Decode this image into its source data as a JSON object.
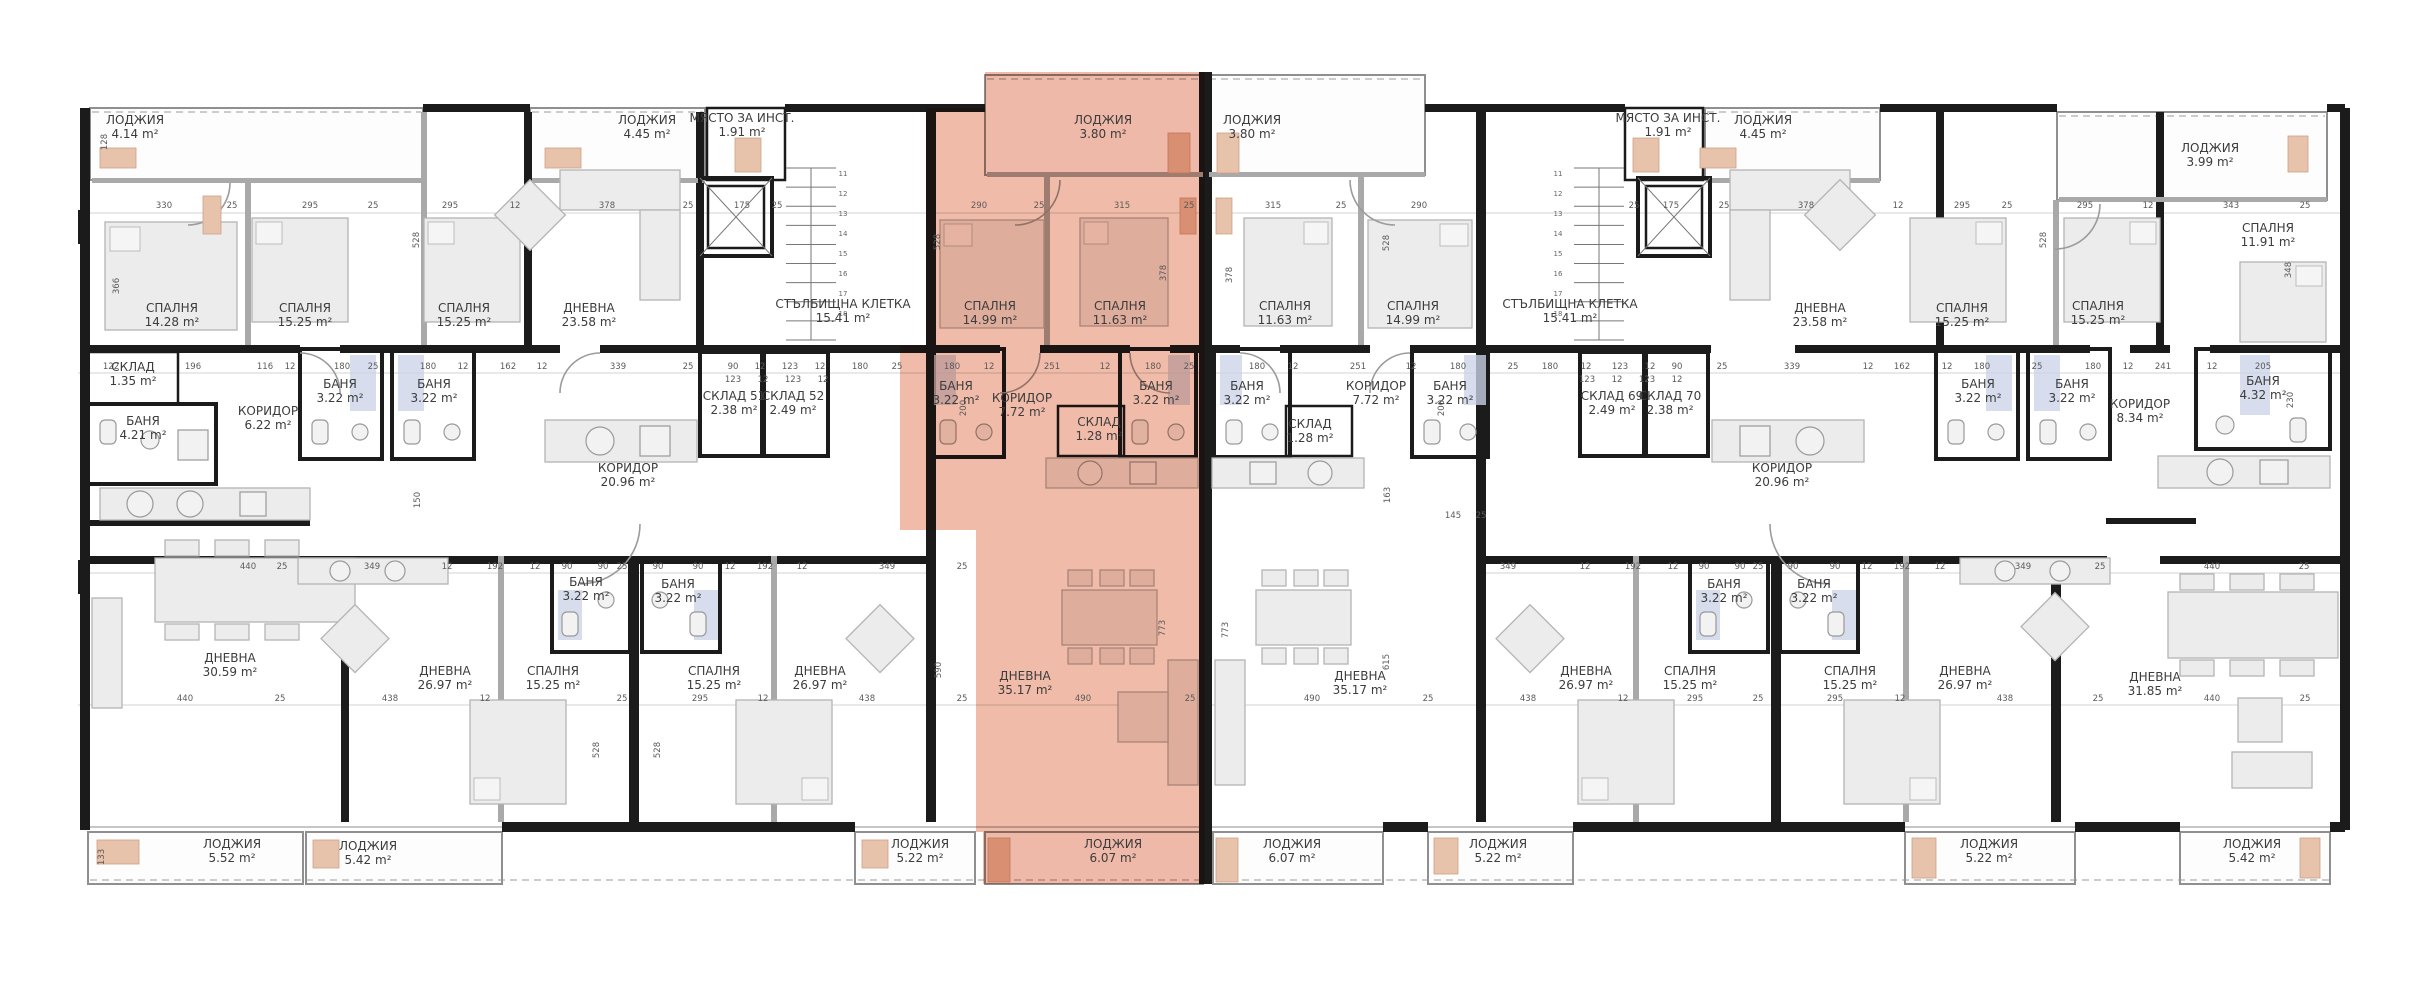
{
  "plan": {
    "type": "apartment-building-floor-plan",
    "language": "bg",
    "unit": "m²",
    "highlight_color": "#e06c4e",
    "wall_color": "#1b1b1b"
  },
  "rooms": [
    {
      "n": "ЛОДЖИЯ",
      "a": "4.14 m²",
      "x": 135,
      "y": 124,
      "hl": false
    },
    {
      "n": "ЛОДЖИЯ",
      "a": "4.45 m²",
      "x": 647,
      "y": 124,
      "hl": false
    },
    {
      "n": "МЯСТО ЗА ИНСТ.",
      "a": "1.91 m²",
      "x": 742,
      "y": 122,
      "hl": false
    },
    {
      "n": "ЛОДЖИЯ",
      "a": "3.80 m²",
      "x": 1103,
      "y": 124,
      "hl": true
    },
    {
      "n": "ЛОДЖИЯ",
      "a": "3.80 m²",
      "x": 1252,
      "y": 124,
      "hl": false
    },
    {
      "n": "МЯСТО ЗА ИНСТ.",
      "a": "1.91 m²",
      "x": 1668,
      "y": 122,
      "hl": false
    },
    {
      "n": "ЛОДЖИЯ",
      "a": "4.45 m²",
      "x": 1763,
      "y": 124,
      "hl": false
    },
    {
      "n": "ЛОДЖИЯ",
      "a": "3.99 m²",
      "x": 2210,
      "y": 152,
      "hl": false
    },
    {
      "n": "СПАЛНЯ",
      "a": "14.28 m²",
      "x": 172,
      "y": 312,
      "hl": false
    },
    {
      "n": "СПАЛНЯ",
      "a": "15.25 m²",
      "x": 305,
      "y": 312,
      "hl": false
    },
    {
      "n": "СПАЛНЯ",
      "a": "15.25 m²",
      "x": 464,
      "y": 312,
      "hl": false
    },
    {
      "n": "ДНЕВНА",
      "a": "23.58 m²",
      "x": 589,
      "y": 312,
      "hl": false
    },
    {
      "n": "СТЪЛБИЩНА КЛЕТКА",
      "a": "15.41 m²",
      "x": 843,
      "y": 308,
      "hl": false
    },
    {
      "n": "СПАЛНЯ",
      "a": "14.99 m²",
      "x": 990,
      "y": 310,
      "hl": true
    },
    {
      "n": "СПАЛНЯ",
      "a": "11.63 m²",
      "x": 1120,
      "y": 310,
      "hl": true
    },
    {
      "n": "СПАЛНЯ",
      "a": "11.63 m²",
      "x": 1285,
      "y": 310,
      "hl": false
    },
    {
      "n": "СПАЛНЯ",
      "a": "14.99 m²",
      "x": 1413,
      "y": 310,
      "hl": false
    },
    {
      "n": "СТЪЛБИЩНА КЛЕТКА",
      "a": "15.41 m²",
      "x": 1570,
      "y": 308,
      "hl": false
    },
    {
      "n": "ДНЕВНА",
      "a": "23.58 m²",
      "x": 1820,
      "y": 312,
      "hl": false
    },
    {
      "n": "СПАЛНЯ",
      "a": "15.25 m²",
      "x": 1962,
      "y": 312,
      "hl": false
    },
    {
      "n": "СПАЛНЯ",
      "a": "15.25 m²",
      "x": 2098,
      "y": 310,
      "hl": false
    },
    {
      "n": "СПАЛНЯ",
      "a": "11.91 m²",
      "x": 2268,
      "y": 232,
      "hl": false
    },
    {
      "n": "СКЛАД",
      "a": "1.35 m²",
      "x": 133,
      "y": 371,
      "hl": false
    },
    {
      "n": "БАНЯ",
      "a": "4.21 m²",
      "x": 143,
      "y": 425,
      "hl": false
    },
    {
      "n": "КОРИДОР",
      "a": "6.22 m²",
      "x": 268,
      "y": 415,
      "hl": false
    },
    {
      "n": "БАНЯ",
      "a": "3.22 m²",
      "x": 340,
      "y": 388,
      "hl": false
    },
    {
      "n": "БАНЯ",
      "a": "3.22 m²",
      "x": 434,
      "y": 388,
      "hl": false
    },
    {
      "n": "КОРИДОР",
      "a": "20.96 m²",
      "x": 628,
      "y": 472,
      "hl": false
    },
    {
      "n": "СКЛАД 51",
      "a": "2.38 m²",
      "x": 734,
      "y": 400,
      "hl": false
    },
    {
      "n": "СКЛАД 52",
      "a": "2.49 m²",
      "x": 793,
      "y": 400,
      "hl": false
    },
    {
      "n": "БАНЯ",
      "a": "3.22 m²",
      "x": 956,
      "y": 390,
      "hl": true
    },
    {
      "n": "КОРИДОР",
      "a": "7.72 m²",
      "x": 1022,
      "y": 402,
      "hl": true
    },
    {
      "n": "СКЛАД",
      "a": "1.28 m²",
      "x": 1099,
      "y": 426,
      "hl": true
    },
    {
      "n": "БАНЯ",
      "a": "3.22 m²",
      "x": 1156,
      "y": 390,
      "hl": true
    },
    {
      "n": "БАНЯ",
      "a": "3.22 m²",
      "x": 1247,
      "y": 390,
      "hl": false
    },
    {
      "n": "СКЛАД",
      "a": "1.28 m²",
      "x": 1310,
      "y": 428,
      "hl": false
    },
    {
      "n": "КОРИДОР",
      "a": "7.72 m²",
      "x": 1376,
      "y": 390,
      "hl": false
    },
    {
      "n": "БАНЯ",
      "a": "3.22 m²",
      "x": 1450,
      "y": 390,
      "hl": false
    },
    {
      "n": "СКЛАД 69",
      "a": "2.49 m²",
      "x": 1612,
      "y": 400,
      "hl": false
    },
    {
      "n": "СКЛАД 70",
      "a": "2.38 m²",
      "x": 1670,
      "y": 400,
      "hl": false
    },
    {
      "n": "КОРИДОР",
      "a": "20.96 m²",
      "x": 1782,
      "y": 472,
      "hl": false
    },
    {
      "n": "БАНЯ",
      "a": "3.22 m²",
      "x": 1978,
      "y": 388,
      "hl": false
    },
    {
      "n": "БАНЯ",
      "a": "3.22 m²",
      "x": 2072,
      "y": 388,
      "hl": false
    },
    {
      "n": "КОРИДОР",
      "a": "8.34 m²",
      "x": 2140,
      "y": 408,
      "hl": false
    },
    {
      "n": "БАНЯ",
      "a": "4.32 m²",
      "x": 2263,
      "y": 385,
      "hl": false
    },
    {
      "n": "БАНЯ",
      "a": "3.22 m²",
      "x": 586,
      "y": 586,
      "hl": false
    },
    {
      "n": "БАНЯ",
      "a": "3.22 m²",
      "x": 678,
      "y": 588,
      "hl": false
    },
    {
      "n": "БАНЯ",
      "a": "3.22 m²",
      "x": 1724,
      "y": 588,
      "hl": false
    },
    {
      "n": "БАНЯ",
      "a": "3.22 m²",
      "x": 1814,
      "y": 588,
      "hl": false
    },
    {
      "n": "ДНЕВНА",
      "a": "30.59 m²",
      "x": 230,
      "y": 662,
      "hl": false
    },
    {
      "n": "ДНЕВНА",
      "a": "26.97 m²",
      "x": 445,
      "y": 675,
      "hl": false
    },
    {
      "n": "СПАЛНЯ",
      "a": "15.25 m²",
      "x": 553,
      "y": 675,
      "hl": false
    },
    {
      "n": "СПАЛНЯ",
      "a": "15.25 m²",
      "x": 714,
      "y": 675,
      "hl": false
    },
    {
      "n": "ДНЕВНА",
      "a": "26.97 m²",
      "x": 820,
      "y": 675,
      "hl": false
    },
    {
      "n": "ДНЕВНА",
      "a": "35.17 m²",
      "x": 1025,
      "y": 680,
      "hl": true
    },
    {
      "n": "ДНЕВНА",
      "a": "35.17 m²",
      "x": 1360,
      "y": 680,
      "hl": false
    },
    {
      "n": "ДНЕВНА",
      "a": "26.97 m²",
      "x": 1586,
      "y": 675,
      "hl": false
    },
    {
      "n": "СПАЛНЯ",
      "a": "15.25 m²",
      "x": 1690,
      "y": 675,
      "hl": false
    },
    {
      "n": "СПАЛНЯ",
      "a": "15.25 m²",
      "x": 1850,
      "y": 675,
      "hl": false
    },
    {
      "n": "ДНЕВНА",
      "a": "26.97 m²",
      "x": 1965,
      "y": 675,
      "hl": false
    },
    {
      "n": "ДНЕВНА",
      "a": "31.85 m²",
      "x": 2155,
      "y": 681,
      "hl": false
    },
    {
      "n": "ЛОДЖИЯ",
      "a": "5.52 m²",
      "x": 232,
      "y": 848,
      "hl": false
    },
    {
      "n": "ЛОДЖИЯ",
      "a": "5.42 m²",
      "x": 368,
      "y": 850,
      "hl": false
    },
    {
      "n": "ЛОДЖИЯ",
      "a": "5.22 m²",
      "x": 920,
      "y": 848,
      "hl": false
    },
    {
      "n": "ЛОДЖИЯ",
      "a": "6.07 m²",
      "x": 1113,
      "y": 848,
      "hl": true
    },
    {
      "n": "ЛОДЖИЯ",
      "a": "6.07 m²",
      "x": 1292,
      "y": 848,
      "hl": false
    },
    {
      "n": "ЛОДЖИЯ",
      "a": "5.22 m²",
      "x": 1498,
      "y": 848,
      "hl": false
    },
    {
      "n": "ЛОДЖИЯ",
      "a": "5.22 m²",
      "x": 1989,
      "y": 848,
      "hl": false
    },
    {
      "n": "ЛОДЖИЯ",
      "a": "5.42 m²",
      "x": 2252,
      "y": 848,
      "hl": false
    }
  ],
  "dimensions": {
    "horizontal": [
      {
        "t": "330",
        "x": 164,
        "y": 208
      },
      {
        "t": "25",
        "x": 232,
        "y": 208
      },
      {
        "t": "295",
        "x": 310,
        "y": 208
      },
      {
        "t": "25",
        "x": 373,
        "y": 208
      },
      {
        "t": "295",
        "x": 450,
        "y": 208
      },
      {
        "t": "12",
        "x": 515,
        "y": 208
      },
      {
        "t": "378",
        "x": 607,
        "y": 208
      },
      {
        "t": "25",
        "x": 688,
        "y": 208
      },
      {
        "t": "175",
        "x": 742,
        "y": 208
      },
      {
        "t": "25",
        "x": 777,
        "y": 208
      },
      {
        "t": "290",
        "x": 979,
        "y": 208
      },
      {
        "t": "25",
        "x": 1039,
        "y": 208
      },
      {
        "t": "315",
        "x": 1122,
        "y": 208
      },
      {
        "t": "25",
        "x": 1189,
        "y": 208
      },
      {
        "t": "315",
        "x": 1273,
        "y": 208
      },
      {
        "t": "25",
        "x": 1341,
        "y": 208
      },
      {
        "t": "290",
        "x": 1419,
        "y": 208
      },
      {
        "t": "25",
        "x": 1634,
        "y": 208
      },
      {
        "t": "175",
        "x": 1671,
        "y": 208
      },
      {
        "t": "25",
        "x": 1724,
        "y": 208
      },
      {
        "t": "378",
        "x": 1806,
        "y": 208
      },
      {
        "t": "12",
        "x": 1898,
        "y": 208
      },
      {
        "t": "295",
        "x": 1962,
        "y": 208
      },
      {
        "t": "25",
        "x": 2007,
        "y": 208
      },
      {
        "t": "295",
        "x": 2085,
        "y": 208
      },
      {
        "t": "12",
        "x": 2148,
        "y": 208
      },
      {
        "t": "343",
        "x": 2231,
        "y": 208
      },
      {
        "t": "25",
        "x": 2305,
        "y": 208
      },
      {
        "t": "122",
        "x": 111,
        "y": 369
      },
      {
        "t": "196",
        "x": 193,
        "y": 369
      },
      {
        "t": "116",
        "x": 265,
        "y": 369
      },
      {
        "t": "12",
        "x": 290,
        "y": 369
      },
      {
        "t": "180",
        "x": 342,
        "y": 369
      },
      {
        "t": "25",
        "x": 373,
        "y": 369
      },
      {
        "t": "180",
        "x": 428,
        "y": 369
      },
      {
        "t": "12",
        "x": 463,
        "y": 369
      },
      {
        "t": "162",
        "x": 508,
        "y": 369
      },
      {
        "t": "12",
        "x": 542,
        "y": 369
      },
      {
        "t": "339",
        "x": 618,
        "y": 369
      },
      {
        "t": "25",
        "x": 688,
        "y": 369
      },
      {
        "t": "90",
        "x": 733,
        "y": 369
      },
      {
        "t": "12",
        "x": 760,
        "y": 369
      },
      {
        "t": "123",
        "x": 790,
        "y": 369
      },
      {
        "t": "12",
        "x": 820,
        "y": 369
      },
      {
        "t": "180",
        "x": 860,
        "y": 369
      },
      {
        "t": "25",
        "x": 897,
        "y": 369
      },
      {
        "t": "180",
        "x": 952,
        "y": 369
      },
      {
        "t": "12",
        "x": 989,
        "y": 369
      },
      {
        "t": "251",
        "x": 1052,
        "y": 369
      },
      {
        "t": "12",
        "x": 1105,
        "y": 369
      },
      {
        "t": "180",
        "x": 1153,
        "y": 369
      },
      {
        "t": "25",
        "x": 1189,
        "y": 369
      },
      {
        "t": "180",
        "x": 1257,
        "y": 369
      },
      {
        "t": "12",
        "x": 1293,
        "y": 369
      },
      {
        "t": "251",
        "x": 1358,
        "y": 369
      },
      {
        "t": "12",
        "x": 1411,
        "y": 369
      },
      {
        "t": "180",
        "x": 1458,
        "y": 369
      },
      {
        "t": "25",
        "x": 1513,
        "y": 369
      },
      {
        "t": "180",
        "x": 1550,
        "y": 369
      },
      {
        "t": "12",
        "x": 1586,
        "y": 369
      },
      {
        "t": "123",
        "x": 1620,
        "y": 369
      },
      {
        "t": "12",
        "x": 1650,
        "y": 369
      },
      {
        "t": "90",
        "x": 1677,
        "y": 369
      },
      {
        "t": "25",
        "x": 1722,
        "y": 369
      },
      {
        "t": "339",
        "x": 1792,
        "y": 369
      },
      {
        "t": "12",
        "x": 1868,
        "y": 369
      },
      {
        "t": "162",
        "x": 1902,
        "y": 369
      },
      {
        "t": "12",
        "x": 1947,
        "y": 369
      },
      {
        "t": "180",
        "x": 1982,
        "y": 369
      },
      {
        "t": "25",
        "x": 2037,
        "y": 369
      },
      {
        "t": "180",
        "x": 2093,
        "y": 369
      },
      {
        "t": "12",
        "x": 2128,
        "y": 369
      },
      {
        "t": "241",
        "x": 2163,
        "y": 369
      },
      {
        "t": "12",
        "x": 2212,
        "y": 369
      },
      {
        "t": "205",
        "x": 2263,
        "y": 369
      },
      {
        "t": "123",
        "x": 733,
        "y": 382
      },
      {
        "t": "12",
        "x": 763,
        "y": 382
      },
      {
        "t": "123",
        "x": 793,
        "y": 382
      },
      {
        "t": "12",
        "x": 823,
        "y": 382
      },
      {
        "t": "123",
        "x": 1587,
        "y": 382
      },
      {
        "t": "12",
        "x": 1617,
        "y": 382
      },
      {
        "t": "123",
        "x": 1647,
        "y": 382
      },
      {
        "t": "12",
        "x": 1677,
        "y": 382
      },
      {
        "t": "145",
        "x": 1453,
        "y": 518
      },
      {
        "t": "25",
        "x": 1481,
        "y": 518
      },
      {
        "t": "440",
        "x": 248,
        "y": 569
      },
      {
        "t": "25",
        "x": 282,
        "y": 569
      },
      {
        "t": "349",
        "x": 372,
        "y": 569
      },
      {
        "t": "12",
        "x": 447,
        "y": 569
      },
      {
        "t": "192",
        "x": 495,
        "y": 569
      },
      {
        "t": "12",
        "x": 535,
        "y": 569
      },
      {
        "t": "90",
        "x": 567,
        "y": 569
      },
      {
        "t": "90",
        "x": 603,
        "y": 569
      },
      {
        "t": "25",
        "x": 622,
        "y": 569
      },
      {
        "t": "90",
        "x": 658,
        "y": 569
      },
      {
        "t": "90",
        "x": 698,
        "y": 569
      },
      {
        "t": "12",
        "x": 730,
        "y": 569
      },
      {
        "t": "192",
        "x": 765,
        "y": 569
      },
      {
        "t": "12",
        "x": 802,
        "y": 569
      },
      {
        "t": "349",
        "x": 887,
        "y": 569
      },
      {
        "t": "25",
        "x": 962,
        "y": 569
      },
      {
        "t": "349",
        "x": 1508,
        "y": 569
      },
      {
        "t": "12",
        "x": 1585,
        "y": 569
      },
      {
        "t": "192",
        "x": 1633,
        "y": 569
      },
      {
        "t": "12",
        "x": 1673,
        "y": 569
      },
      {
        "t": "90",
        "x": 1704,
        "y": 569
      },
      {
        "t": "90",
        "x": 1740,
        "y": 569
      },
      {
        "t": "25",
        "x": 1758,
        "y": 569
      },
      {
        "t": "90",
        "x": 1793,
        "y": 569
      },
      {
        "t": "90",
        "x": 1835,
        "y": 569
      },
      {
        "t": "12",
        "x": 1867,
        "y": 569
      },
      {
        "t": "192",
        "x": 1902,
        "y": 569
      },
      {
        "t": "12",
        "x": 1940,
        "y": 569
      },
      {
        "t": "349",
        "x": 2023,
        "y": 569
      },
      {
        "t": "25",
        "x": 2100,
        "y": 569
      },
      {
        "t": "440",
        "x": 2212,
        "y": 569
      },
      {
        "t": "25",
        "x": 2304,
        "y": 569
      },
      {
        "t": "440",
        "x": 185,
        "y": 701
      },
      {
        "t": "25",
        "x": 280,
        "y": 701
      },
      {
        "t": "438",
        "x": 390,
        "y": 701
      },
      {
        "t": "12",
        "x": 485,
        "y": 701
      },
      {
        "t": "25",
        "x": 622,
        "y": 701
      },
      {
        "t": "295",
        "x": 700,
        "y": 701
      },
      {
        "t": "12",
        "x": 763,
        "y": 701
      },
      {
        "t": "438",
        "x": 867,
        "y": 701
      },
      {
        "t": "25",
        "x": 962,
        "y": 701
      },
      {
        "t": "490",
        "x": 1083,
        "y": 701
      },
      {
        "t": "25",
        "x": 1190,
        "y": 701
      },
      {
        "t": "490",
        "x": 1312,
        "y": 701
      },
      {
        "t": "25",
        "x": 1428,
        "y": 701
      },
      {
        "t": "438",
        "x": 1528,
        "y": 701
      },
      {
        "t": "12",
        "x": 1623,
        "y": 701
      },
      {
        "t": "295",
        "x": 1695,
        "y": 701
      },
      {
        "t": "25",
        "x": 1758,
        "y": 701
      },
      {
        "t": "295",
        "x": 1835,
        "y": 701
      },
      {
        "t": "12",
        "x": 1900,
        "y": 701
      },
      {
        "t": "438",
        "x": 2005,
        "y": 701
      },
      {
        "t": "25",
        "x": 2098,
        "y": 701
      },
      {
        "t": "440",
        "x": 2212,
        "y": 701
      },
      {
        "t": "25",
        "x": 2305,
        "y": 701
      }
    ],
    "vertical": [
      {
        "t": "128",
        "x": 107,
        "y": 142
      },
      {
        "t": "366",
        "x": 119,
        "y": 286
      },
      {
        "t": "528",
        "x": 419,
        "y": 240
      },
      {
        "t": "528",
        "x": 940,
        "y": 242
      },
      {
        "t": "378",
        "x": 1166,
        "y": 273
      },
      {
        "t": "378",
        "x": 1232,
        "y": 275
      },
      {
        "t": "528",
        "x": 1389,
        "y": 243
      },
      {
        "t": "528",
        "x": 2046,
        "y": 240
      },
      {
        "t": "348",
        "x": 2291,
        "y": 270
      },
      {
        "t": "200",
        "x": 966,
        "y": 408
      },
      {
        "t": "200",
        "x": 1444,
        "y": 408
      },
      {
        "t": "230",
        "x": 2293,
        "y": 400
      },
      {
        "t": "150",
        "x": 420,
        "y": 500
      },
      {
        "t": "163",
        "x": 1390,
        "y": 495
      },
      {
        "t": "590",
        "x": 941,
        "y": 670
      },
      {
        "t": "773",
        "x": 1165,
        "y": 628
      },
      {
        "t": "773",
        "x": 1228,
        "y": 630
      },
      {
        "t": "615",
        "x": 1389,
        "y": 662
      },
      {
        "t": "528",
        "x": 599,
        "y": 750
      },
      {
        "t": "528",
        "x": 660,
        "y": 750
      },
      {
        "t": "133",
        "x": 104,
        "y": 857
      }
    ]
  },
  "stairwell": {
    "step_numbers": [
      "11",
      "12",
      "13",
      "14",
      "15",
      "16",
      "17",
      "18"
    ],
    "columns": [
      {
        "x": 843,
        "y0": 176,
        "dy": 20
      },
      {
        "x": 1558,
        "y0": 176,
        "dy": 20
      }
    ]
  }
}
